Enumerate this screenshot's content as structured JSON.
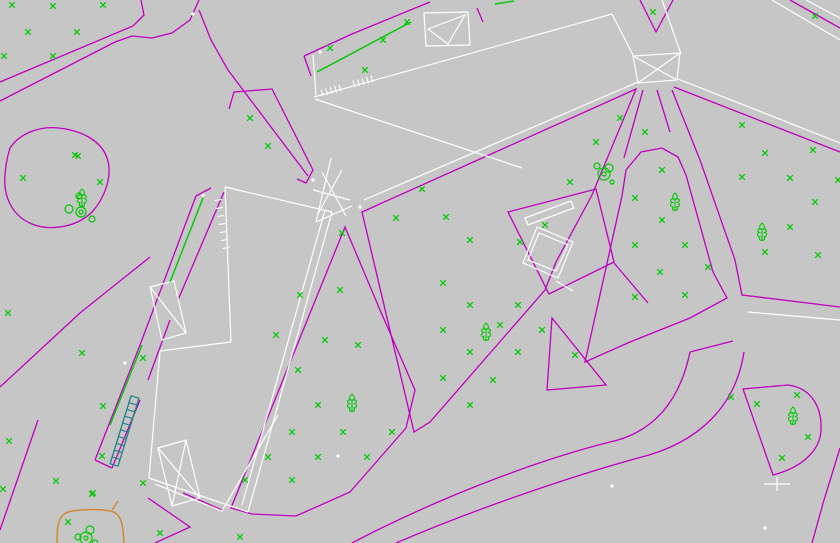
{
  "canvas": {
    "w": 840,
    "h": 543,
    "bg": "#c6c6c6"
  },
  "colors": {
    "parcel_magenta": "#bf00bf",
    "building_white": "#ffffff",
    "vegetation_green": "#00c800",
    "stair_teal": "#1d8383",
    "bed_orange": "#cd8a33"
  },
  "magenta": {
    "polylines": [
      [
        [
          0,
          82
        ],
        [
          133,
          26
        ],
        [
          144,
          15
        ],
        [
          141,
          0
        ]
      ],
      [
        [
          0,
          101
        ],
        [
          115,
          42
        ],
        [
          132,
          36
        ],
        [
          152,
          38
        ],
        [
          172,
          33
        ],
        [
          190,
          20
        ],
        [
          199,
          0
        ]
      ],
      [
        [
          199,
          10
        ],
        [
          211,
          40
        ],
        [
          228,
          70
        ],
        [
          308,
          176
        ]
      ],
      [
        [
          229,
          109
        ],
        [
          234,
          92
        ],
        [
          272,
          89
        ],
        [
          313,
          170
        ],
        [
          306,
          183
        ],
        [
          297,
          179
        ]
      ],
      [
        [
          304,
          56
        ],
        [
          352,
          34
        ],
        [
          430,
          2
        ]
      ],
      [
        [
          304,
          56
        ],
        [
          311,
          76
        ]
      ],
      [
        [
          640,
          0
        ],
        [
          656,
          32
        ],
        [
          673,
          0
        ]
      ],
      [
        [
          674,
          87
        ],
        [
          840,
          152
        ]
      ],
      [
        [
          672,
          90
        ],
        [
          700,
          160
        ],
        [
          735,
          260
        ],
        [
          742,
          295
        ],
        [
          840,
          307
        ]
      ],
      [
        [
          643,
          90
        ],
        [
          624,
          158
        ]
      ],
      [
        [
          657,
          90
        ],
        [
          670,
          132
        ]
      ],
      [
        [
          614,
          263
        ],
        [
          648,
          303
        ]
      ],
      [
        [
          790,
          0
        ],
        [
          840,
          28
        ]
      ],
      [
        [
          150,
          257
        ],
        [
          80,
          313
        ],
        [
          0,
          387
        ]
      ],
      [
        [
          38,
          420
        ],
        [
          0,
          530
        ]
      ],
      [
        [
          95,
          460
        ],
        [
          140,
          345
        ],
        [
          196,
          196
        ],
        [
          211,
          188
        ]
      ],
      [
        [
          112,
          468
        ],
        [
          140,
          400
        ]
      ],
      [
        [
          148,
          380
        ],
        [
          170,
          320
        ]
      ],
      [
        [
          178,
          300
        ],
        [
          224,
          192
        ]
      ],
      [
        [
          95,
          460
        ],
        [
          112,
          468
        ]
      ],
      [
        [
          148,
          498
        ],
        [
          190,
          527
        ],
        [
          155,
          543
        ]
      ],
      [
        [
          183,
          493
        ],
        [
          222,
          510
        ]
      ],
      [
        [
          477,
          8
        ],
        [
          483,
          22
        ]
      ],
      [
        [
          840,
          448
        ],
        [
          824,
          500
        ],
        [
          812,
          543
        ]
      ]
    ],
    "polygons": [
      [
        [
          345,
          227
        ],
        [
          380,
          310
        ],
        [
          415,
          390
        ],
        [
          406,
          428
        ],
        [
          350,
          492
        ],
        [
          296,
          516
        ],
        [
          252,
          514
        ],
        [
          231,
          508
        ]
      ],
      [
        [
          362,
          212
        ],
        [
          636,
          89
        ],
        [
          592,
          195
        ],
        [
          556,
          262
        ],
        [
          545,
          290
        ],
        [
          430,
          422
        ],
        [
          414,
          432
        ]
      ],
      [
        [
          622,
          196
        ],
        [
          626,
          170
        ],
        [
          641,
          152
        ],
        [
          662,
          148
        ],
        [
          678,
          157
        ],
        [
          686,
          175
        ],
        [
          713,
          272
        ],
        [
          727,
          298
        ],
        [
          690,
          318
        ],
        [
          630,
          342
        ],
        [
          585,
          362
        ]
      ],
      [
        [
          552,
          318
        ],
        [
          606,
          385
        ],
        [
          547,
          390
        ]
      ],
      [
        [
          508,
          212
        ],
        [
          596,
          189
        ],
        [
          614,
          262
        ],
        [
          549,
          294
        ]
      ]
    ],
    "paths": [
      "M10,148 C20,133 40,126 58,128 C80,130 101,140 107,158 C113,175 105,198 92,212 C78,226 52,232 32,224 C12,216 3,196 5,175 C6,162 8,155 10,148 Z",
      "M773,475 L743,389 L788,385 C812,388 822,408 821,430 C820,452 800,468 773,475 Z",
      "M352,543 C430,502 530,462 610,442 C655,432 680,400 690,352 L733,341",
      "M396,543 C468,512 565,478 638,458 C700,443 736,405 744,352"
    ]
  },
  "white": {
    "polylines": [
      [
        [
          314,
          97
        ],
        [
          612,
          14
        ]
      ],
      [
        [
          612,
          14
        ],
        [
          634,
          57
        ]
      ],
      [
        [
          662,
          0
        ],
        [
          681,
          54
        ]
      ],
      [
        [
          633,
          56
        ],
        [
          677,
          80
        ]
      ],
      [
        [
          680,
          53
        ],
        [
          638,
          83
        ]
      ],
      [
        [
          638,
          82
        ],
        [
          364,
          200
        ]
      ],
      [
        [
          678,
          79
        ],
        [
          840,
          143
        ]
      ],
      [
        [
          225,
          187
        ],
        [
          332,
          212
        ]
      ],
      [
        [
          332,
          212
        ],
        [
          248,
          512
        ]
      ],
      [
        [
          325,
          210
        ],
        [
          242,
          505
        ]
      ],
      [
        [
          225,
          187
        ],
        [
          231,
          342
        ]
      ],
      [
        [
          231,
          342
        ],
        [
          160,
          351
        ]
      ],
      [
        [
          160,
          351
        ],
        [
          149,
          478
        ]
      ],
      [
        [
          149,
          478
        ],
        [
          248,
          512
        ]
      ],
      [
        [
          331,
          158
        ],
        [
          316,
          222
        ]
      ],
      [
        [
          316,
          222
        ],
        [
          352,
          206
        ]
      ],
      [
        [
          322,
          172
        ],
        [
          346,
          216
        ]
      ],
      [
        [
          342,
          170
        ],
        [
          318,
          214
        ]
      ],
      [
        [
          313,
          190
        ],
        [
          350,
          200
        ]
      ],
      [
        [
          315,
          99
        ],
        [
          522,
          168
        ]
      ],
      [
        [
          155,
          484
        ],
        [
          222,
          511
        ],
        [
          278,
          415
        ]
      ],
      [
        [
          313,
          55
        ],
        [
          316,
          95
        ]
      ],
      [
        [
          748,
          312
        ],
        [
          840,
          320
        ]
      ],
      [
        [
          772,
          0
        ],
        [
          840,
          40
        ]
      ],
      [
        [
          806,
          0
        ],
        [
          840,
          18
        ]
      ],
      [
        [
          764,
          484
        ],
        [
          790,
          484
        ]
      ],
      [
        [
          777,
          477
        ],
        [
          777,
          491
        ]
      ],
      [
        [
          556,
          281
        ],
        [
          573,
          291
        ]
      ],
      [
        [
          158,
          448
        ],
        [
          200,
          498
        ]
      ],
      [
        [
          186,
          440
        ],
        [
          172,
          506
        ]
      ],
      [
        [
          150,
          287
        ],
        [
          186,
          333
        ]
      ]
    ],
    "polygons": [
      [
        [
          633,
          56
        ],
        [
          680,
          53
        ],
        [
          677,
          80
        ],
        [
          638,
          83
        ]
      ],
      [
        [
          424,
          13
        ],
        [
          468,
          12
        ],
        [
          470,
          45
        ],
        [
          426,
          46
        ]
      ],
      [
        [
          428,
          29
        ],
        [
          465,
          15
        ],
        [
          448,
          44
        ]
      ],
      [
        [
          537,
          227
        ],
        [
          573,
          242
        ],
        [
          558,
          278
        ],
        [
          523,
          263
        ]
      ],
      [
        [
          539,
          233
        ],
        [
          568,
          245
        ],
        [
          556,
          271
        ],
        [
          528,
          260
        ]
      ],
      [
        [
          525,
          218
        ],
        [
          571,
          201
        ],
        [
          574,
          208
        ],
        [
          528,
          225
        ]
      ],
      [
        [
          158,
          448
        ],
        [
          186,
          440
        ],
        [
          200,
          498
        ],
        [
          172,
          506
        ]
      ],
      [
        [
          150,
          287
        ],
        [
          174,
          281
        ],
        [
          186,
          333
        ],
        [
          162,
          340
        ]
      ]
    ],
    "dots": [
      [
        193,
        14
      ],
      [
        320,
        52
      ],
      [
        203,
        195
      ],
      [
        125,
        363
      ],
      [
        338,
        456
      ],
      [
        612,
        486
      ],
      [
        765,
        528
      ],
      [
        313,
        180
      ],
      [
        360,
        207
      ]
    ]
  },
  "teal": {
    "polylines": [
      [
        [
          110,
          464
        ],
        [
          131,
          396
        ]
      ],
      [
        [
          118,
          466
        ],
        [
          139,
          398
        ]
      ]
    ]
  },
  "combs": [
    {
      "seg": [
        322,
        93,
        340,
        88
      ],
      "n": 5,
      "len": 7,
      "color": "building_white"
    },
    {
      "seg": [
        354,
        84,
        372,
        79
      ],
      "n": 5,
      "len": 7,
      "color": "building_white"
    },
    {
      "seg": [
        218,
        200,
        226,
        248
      ],
      "n": 7,
      "len": 7,
      "color": "building_white"
    },
    {
      "seg": [
        114,
        465,
        135,
        397
      ],
      "n": 11,
      "len": 9,
      "color": "stair_teal"
    }
  ],
  "green": {
    "lines": [
      [
        [
          317,
          72
        ],
        [
          411,
          22
        ]
      ],
      [
        [
          110,
          425
        ],
        [
          142,
          345
        ]
      ],
      [
        [
          170,
          282
        ],
        [
          203,
          198
        ]
      ],
      [
        [
          495,
          4
        ],
        [
          514,
          1
        ]
      ]
    ],
    "grass_marks": [
      [
        12,
        5
      ],
      [
        53,
        6
      ],
      [
        103,
        5
      ],
      [
        28,
        32
      ],
      [
        77,
        32
      ],
      [
        4,
        56
      ],
      [
        53,
        56
      ],
      [
        23,
        178
      ],
      [
        78,
        156
      ],
      [
        100,
        182
      ],
      [
        75,
        155
      ],
      [
        330,
        48
      ],
      [
        383,
        40
      ],
      [
        365,
        70
      ],
      [
        407,
        22
      ],
      [
        250,
        118
      ],
      [
        268,
        146
      ],
      [
        653,
        12
      ],
      [
        815,
        16
      ],
      [
        342,
        233
      ],
      [
        300,
        295
      ],
      [
        340,
        290
      ],
      [
        276,
        335
      ],
      [
        325,
        340
      ],
      [
        298,
        370
      ],
      [
        358,
        345
      ],
      [
        318,
        405
      ],
      [
        292,
        432
      ],
      [
        343,
        432
      ],
      [
        392,
        432
      ],
      [
        268,
        457
      ],
      [
        318,
        457
      ],
      [
        367,
        457
      ],
      [
        245,
        480
      ],
      [
        292,
        480
      ],
      [
        422,
        189
      ],
      [
        396,
        218
      ],
      [
        446,
        217
      ],
      [
        470,
        240
      ],
      [
        520,
        242
      ],
      [
        545,
        225
      ],
      [
        570,
        182
      ],
      [
        596,
        142
      ],
      [
        620,
        118
      ],
      [
        443,
        283
      ],
      [
        470,
        305
      ],
      [
        518,
        305
      ],
      [
        443,
        330
      ],
      [
        542,
        330
      ],
      [
        470,
        352
      ],
      [
        518,
        352
      ],
      [
        443,
        378
      ],
      [
        493,
        380
      ],
      [
        470,
        405
      ],
      [
        500,
        325
      ],
      [
        575,
        355
      ],
      [
        662,
        170
      ],
      [
        635,
        198
      ],
      [
        662,
        220
      ],
      [
        635,
        245
      ],
      [
        685,
        245
      ],
      [
        660,
        272
      ],
      [
        635,
        297
      ],
      [
        685,
        295
      ],
      [
        708,
        267
      ],
      [
        645,
        132
      ],
      [
        742,
        125
      ],
      [
        765,
        153
      ],
      [
        813,
        150
      ],
      [
        742,
        177
      ],
      [
        790,
        178
      ],
      [
        815,
        202
      ],
      [
        790,
        227
      ],
      [
        765,
        252
      ],
      [
        818,
        255
      ],
      [
        838,
        180
      ],
      [
        757,
        404
      ],
      [
        797,
        395
      ],
      [
        808,
        437
      ],
      [
        782,
        458
      ],
      [
        731,
        397
      ],
      [
        82,
        353
      ],
      [
        103,
        406
      ],
      [
        143,
        358
      ],
      [
        8,
        313
      ],
      [
        9,
        441
      ],
      [
        3,
        489
      ],
      [
        102,
        456
      ],
      [
        143,
        483
      ],
      [
        93,
        493
      ],
      [
        56,
        481
      ],
      [
        92,
        494
      ],
      [
        68,
        522
      ],
      [
        160,
        533
      ],
      [
        240,
        537
      ]
    ],
    "trees": [
      [
        82,
        198
      ],
      [
        352,
        403
      ],
      [
        486,
        332
      ],
      [
        675,
        202
      ],
      [
        762,
        232
      ],
      [
        793,
        416
      ]
    ],
    "circles": [
      [
        79,
        196,
        3
      ],
      [
        69,
        209,
        4
      ],
      [
        81,
        212,
        5
      ],
      [
        81,
        212,
        2
      ],
      [
        92,
        219,
        3
      ],
      [
        597,
        166,
        3
      ],
      [
        609,
        168,
        4
      ],
      [
        604,
        174,
        6
      ],
      [
        604,
        174,
        2
      ],
      [
        612,
        182,
        2
      ],
      [
        78,
        537,
        3
      ],
      [
        90,
        530,
        4
      ],
      [
        86,
        538,
        6
      ],
      [
        86,
        538,
        2
      ],
      [
        95,
        543,
        3
      ]
    ]
  },
  "orange": {
    "paths": [
      "M57,543 C57,525 58,513 72,511 C88,509 100,509 110,511 C122,513 123,525 124,543",
      "M112,510 L118,501"
    ]
  }
}
